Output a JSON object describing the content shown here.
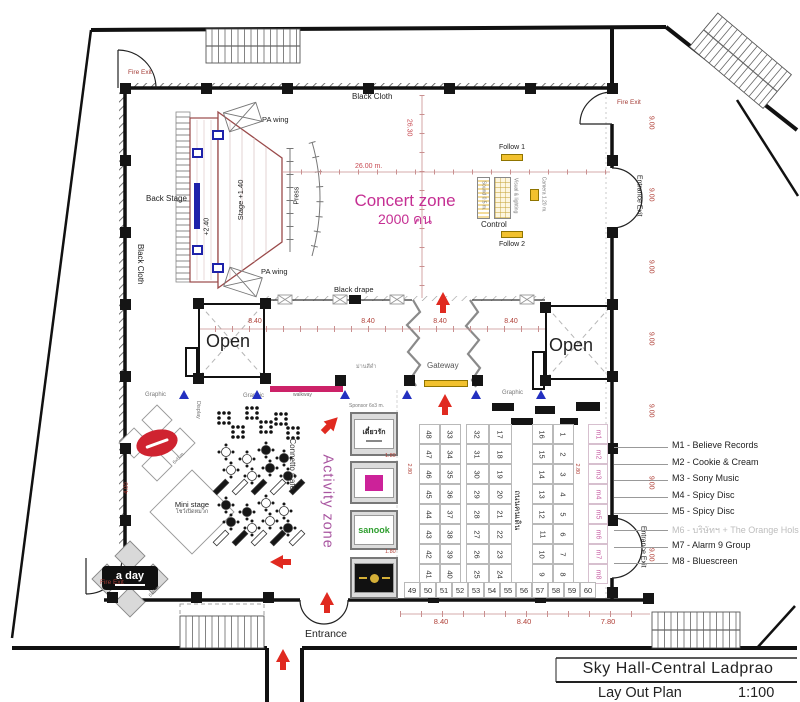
{
  "title_block": {
    "project": "Sky Hall-Central Ladprao",
    "drawing": "Lay Out Plan",
    "scale": "1:100"
  },
  "zones": {
    "concert_zone": {
      "title": "Concert zone",
      "capacity": "2000 คน"
    },
    "activity_zone": "Activity zone",
    "open_left": "Open",
    "open_right": "Open",
    "gateway": "Gateway",
    "cafe": "Connetto Cafe",
    "walking_street": "ถนนคนเดิน",
    "mini_stage": "Mini stage",
    "mini_stage_sub": "โชว์เปิดหมวก",
    "backstage": "Back Stage"
  },
  "stage": {
    "platform": "Stage +1.40",
    "riser": "+2.40",
    "pa_wing_top": "PA wing",
    "pa_wing_bottom": "PA wing",
    "press": "Press"
  },
  "control_area": {
    "follow1": "Follow 1",
    "control": "Control",
    "follow2": "Follow 2",
    "sound": "Sound 0.5 m.",
    "visual": "Visual & lighting",
    "camera": "Camera 1.20 m."
  },
  "doors": {
    "fire_exit": "Fire Exit",
    "entrance": "Entrance",
    "entrance_exit": "Entrance Exit"
  },
  "drapes": {
    "black_cloth_top": "Black Cloth",
    "black_cloth_left": "Black Cloth",
    "black_drape": "Black drape",
    "black_curtain": "ม่านสีดำ"
  },
  "annotations": {
    "graphic": "Graphic",
    "walkway": "walkway",
    "display": "Display",
    "sponsor_size": "Sponsor 6x3 m.",
    "diamond_size": "6x6 m."
  },
  "dimensions": {
    "hall_width": "26.00 m.",
    "hall_width2": "26.30",
    "bay_row": [
      "8.40",
      "8.40",
      "8.40",
      "8.40"
    ],
    "right_bays": [
      "9.00",
      "9.00",
      "9.00",
      "9.00",
      "9.00",
      "9.00",
      "9.00"
    ],
    "bottom_bays": [
      "8.40",
      "8.40",
      "7.80"
    ],
    "aisle1": "1.80",
    "aisle2": "2.80",
    "d400": "4.00"
  },
  "booths": {
    "col_48_41": [
      "48",
      "47",
      "46",
      "45",
      "44",
      "43",
      "42",
      "41"
    ],
    "col_33_40": [
      "33",
      "34",
      "35",
      "36",
      "37",
      "38",
      "39",
      "40"
    ],
    "col_32_25": [
      "32",
      "31",
      "30",
      "29",
      "28",
      "27",
      "26",
      "25"
    ],
    "col_17_24": [
      "17",
      "18",
      "19",
      "20",
      "21",
      "22",
      "23",
      "24"
    ],
    "col_16_9": [
      "16",
      "15",
      "14",
      "13",
      "12",
      "11",
      "10",
      "9"
    ],
    "col_1_8": [
      "1",
      "2",
      "3",
      "4",
      "5",
      "6",
      "7",
      "8"
    ],
    "bottom_row": [
      "49",
      "50",
      "51",
      "52",
      "53",
      "54",
      "55",
      "56",
      "57",
      "58",
      "59",
      "60"
    ],
    "m_column": [
      "m1",
      "m2",
      "m3",
      "m4",
      "m5",
      "m6",
      "m7",
      "m8"
    ]
  },
  "legend": {
    "items": [
      {
        "label": "M1 - Believe Records",
        "muted": false
      },
      {
        "label": "M2 - Cookie & Cream",
        "muted": false
      },
      {
        "label": "M3 - Sony Music",
        "muted": false
      },
      {
        "label": "M4 - Spicy Disc",
        "muted": false
      },
      {
        "label": "M5 - Spicy Disc",
        "muted": false
      },
      {
        "label": "M6 - บริษัทฯ + The Orange Hols",
        "muted": true
      },
      {
        "label": "M7 - Alarm 9 Group",
        "muted": false
      },
      {
        "label": "M8 - Bluescreen",
        "muted": false
      }
    ]
  },
  "sponsors": {
    "booth1": "เดี๋ยวรัก",
    "booth3": "sanook",
    "aday": "a day"
  },
  "colors": {
    "dimension_red": "#b04038",
    "zone_magenta": "#c52f93",
    "activity_purple": "#a855a0",
    "arrow_red": "#e02a20",
    "gateway_yellow": "#f2c12e",
    "walkway_magenta": "#cc2268",
    "marker_blue": "#2330c0",
    "m_label_pink": "#c85fa5"
  }
}
